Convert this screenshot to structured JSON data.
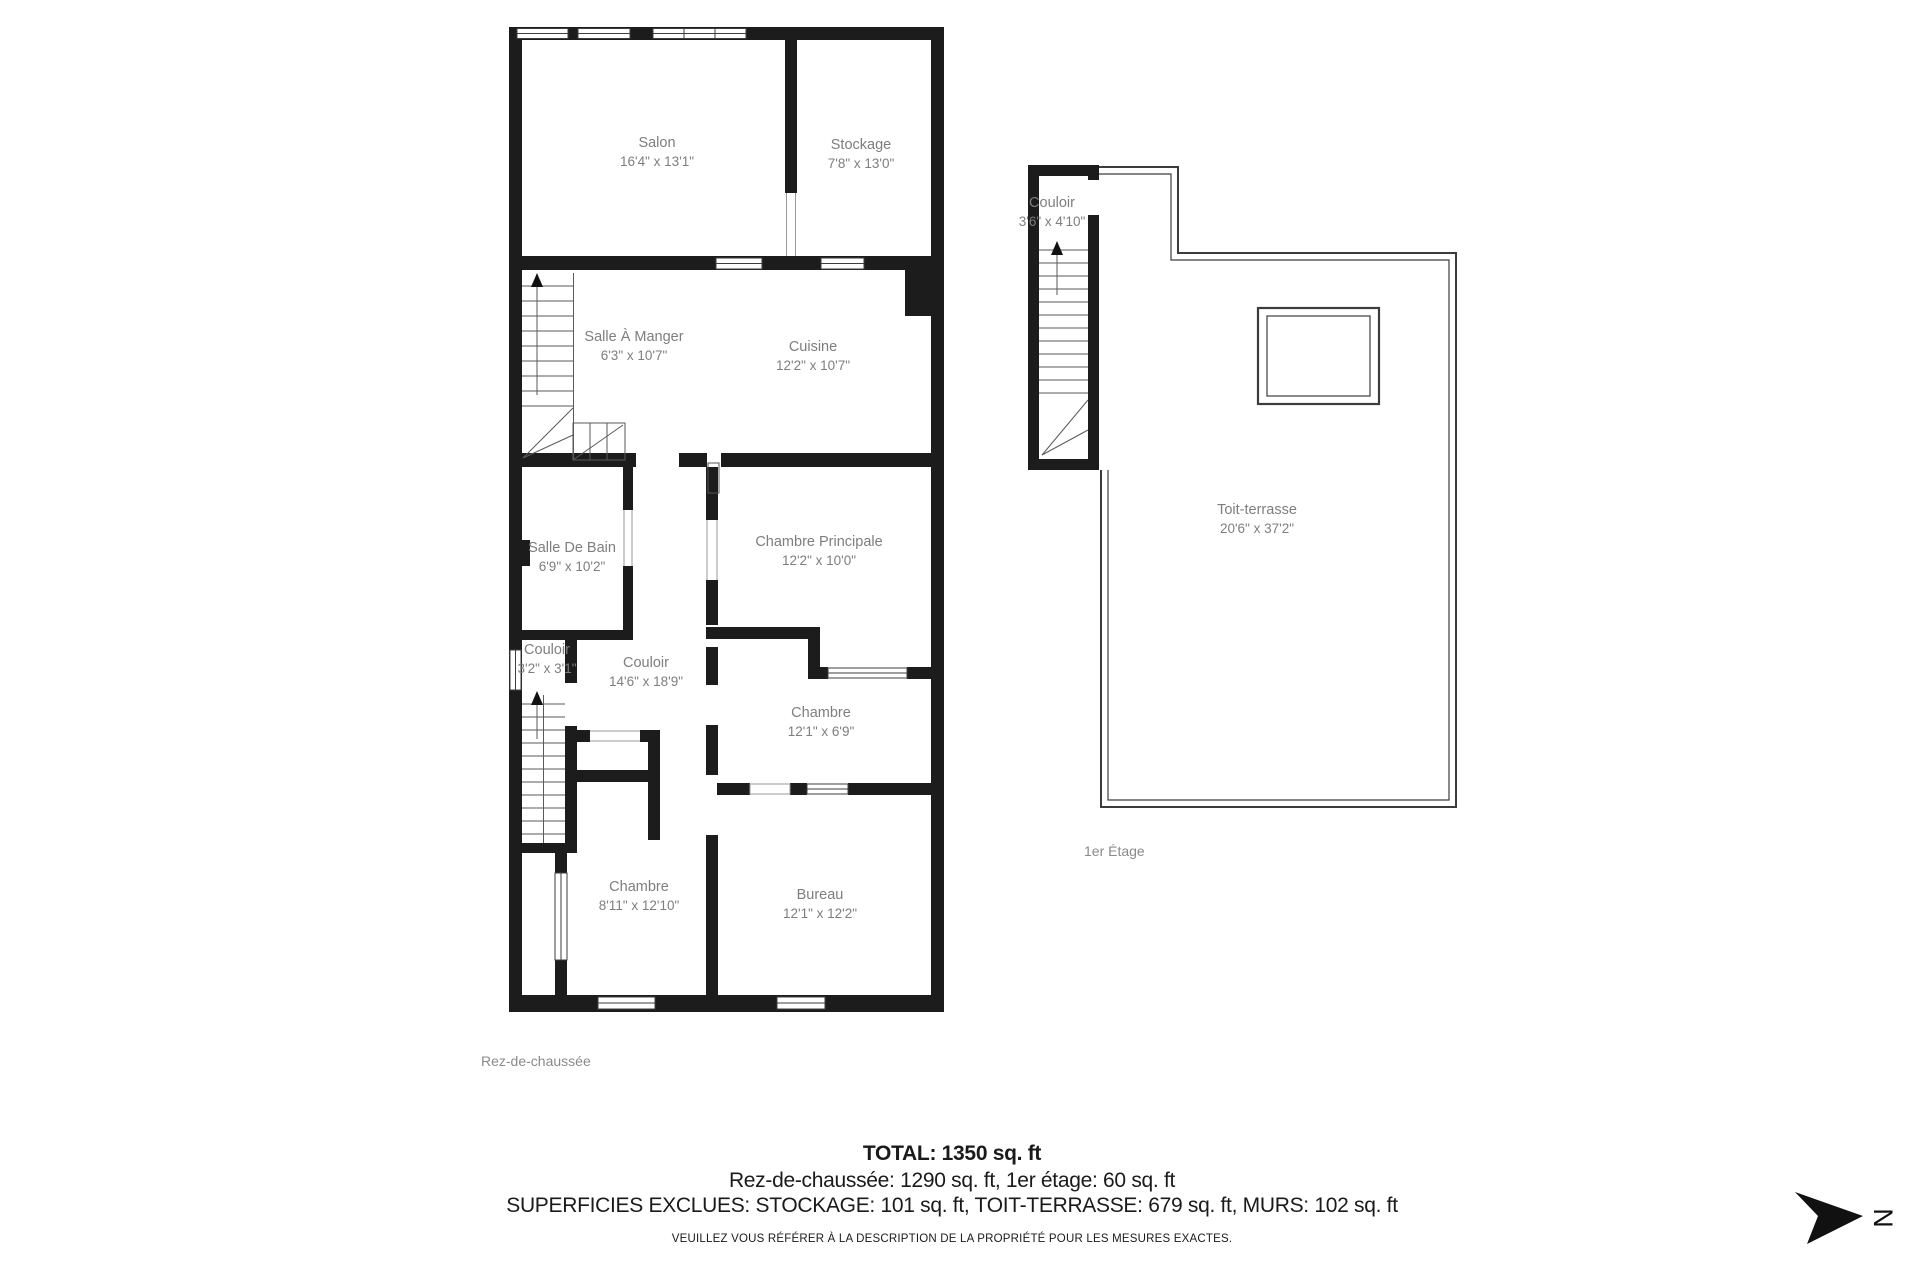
{
  "floorplan": {
    "ground_floor": {
      "label": "Rez-de-chaussée",
      "rooms": [
        {
          "id": "salon",
          "name": "Salon",
          "dims": "16'4\" x 13'1\""
        },
        {
          "id": "stockage",
          "name": "Stockage",
          "dims": "7'8\" x 13'0\""
        },
        {
          "id": "salle-a-manger",
          "name": "Salle À Manger",
          "dims": "6'3\" x 10'7\""
        },
        {
          "id": "cuisine",
          "name": "Cuisine",
          "dims": "12'2\" x 10'7\""
        },
        {
          "id": "salle-de-bain",
          "name": "Salle De Bain",
          "dims": "6'9\" x 10'2\""
        },
        {
          "id": "chambre-principale",
          "name": "Chambre Principale",
          "dims": "12'2\" x 10'0\""
        },
        {
          "id": "couloir-petit",
          "name": "Couloir",
          "dims": "3'2\" x 3'1\""
        },
        {
          "id": "couloir",
          "name": "Couloir",
          "dims": "14'6\" x 18'9\""
        },
        {
          "id": "chambre-1",
          "name": "Chambre",
          "dims": "12'1\" x 6'9\""
        },
        {
          "id": "chambre-2",
          "name": "Chambre",
          "dims": "8'11\" x 12'10\""
        },
        {
          "id": "bureau",
          "name": "Bureau",
          "dims": "12'1\" x 12'2\""
        }
      ]
    },
    "first_floor": {
      "label": "1er Étage",
      "rooms": [
        {
          "id": "couloir-etage",
          "name": "Couloir",
          "dims": "3'6\" x 4'10\""
        },
        {
          "id": "toit-terrasse",
          "name": "Toit-terrasse",
          "dims": "20'6\" x 37'2\""
        }
      ]
    },
    "summary": {
      "total": "TOTAL: 1350 sq. ft",
      "floors": "Rez-de-chaussée: 1290 sq. ft, 1er étage: 60 sq. ft",
      "excluded": "SUPERFICIES EXCLUES: STOCKAGE: 101 sq. ft, TOIT-TERRASSE: 679 sq. ft, MURS: 102 sq. ft",
      "disclaimer": "VEUILLEZ VOUS RÉFÉRER À LA DESCRIPTION DE LA PROPRIÉTÉ POUR LES MESURES EXACTES."
    },
    "compass_letter": "N",
    "colors": {
      "wall": "#1c1c1c",
      "room_label": "#7e7e7e",
      "summary_text": "#1a1a1a"
    }
  }
}
